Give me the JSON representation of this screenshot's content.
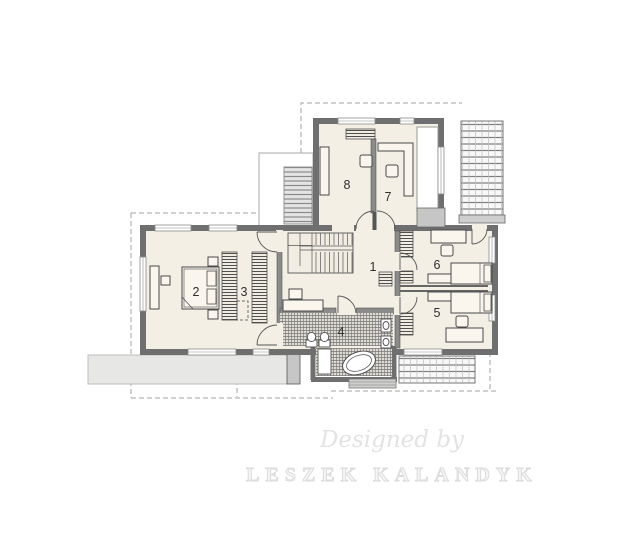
{
  "plan": {
    "rooms": [
      {
        "number": "1"
      },
      {
        "number": "2"
      },
      {
        "number": "3"
      },
      {
        "number": "4"
      },
      {
        "number": "5"
      },
      {
        "number": "6"
      },
      {
        "number": "7"
      },
      {
        "number": "8"
      }
    ],
    "watermark": {
      "line1": "Designed by",
      "line2": "LESZEK KALANDYK"
    }
  },
  "colors": {
    "floor": "#f4efe5",
    "wall": "#6f6f6f",
    "interior_wall": "#8b8b8b",
    "hatch_line": "#787878",
    "terrace": "#e7e7e5",
    "dash": "#a3a3a3",
    "label": "#2f2f2f",
    "watermark": "#dadada"
  }
}
